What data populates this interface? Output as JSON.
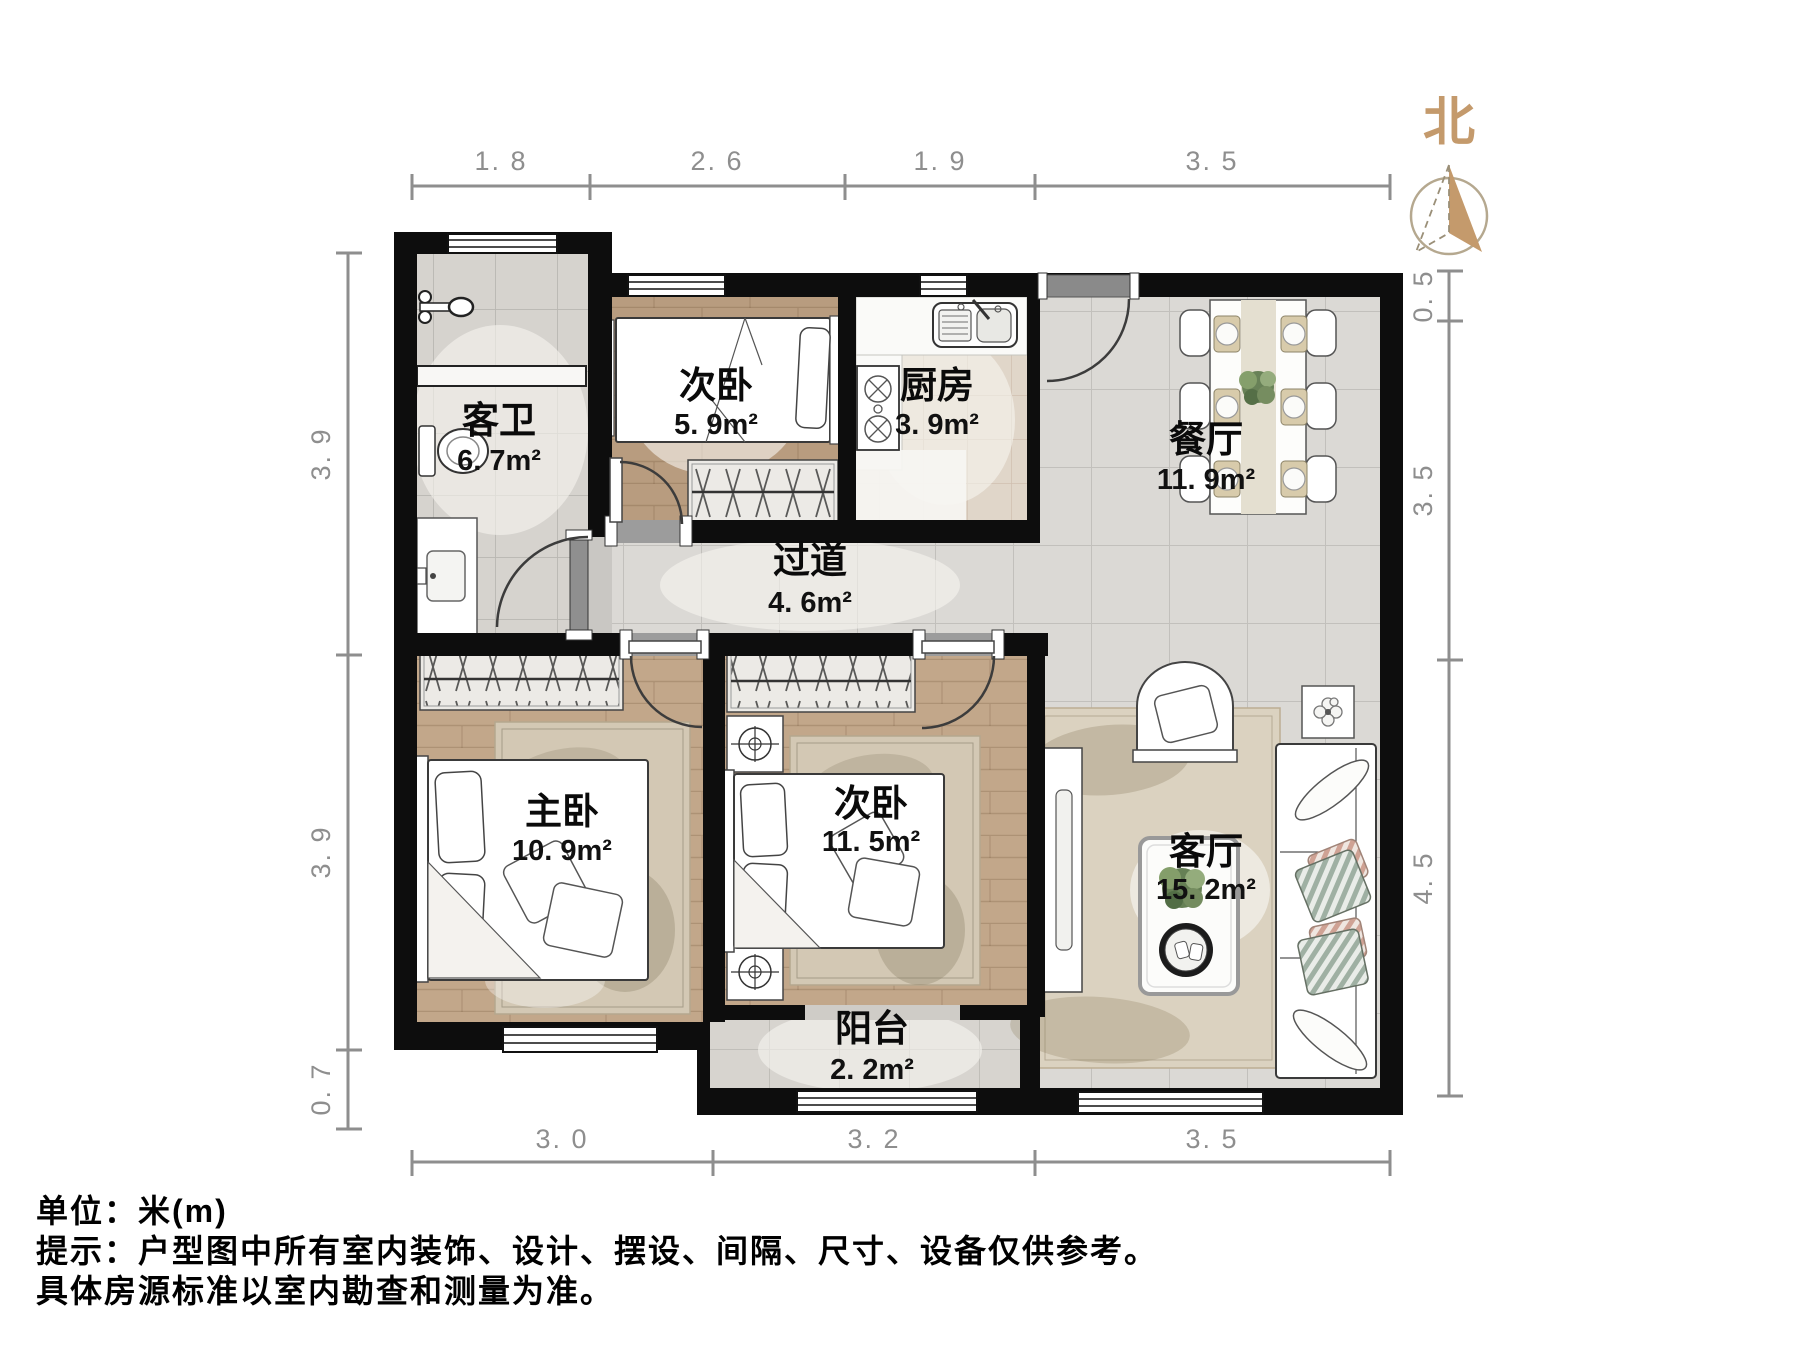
{
  "page": {
    "unit_note": "单位：米(m)",
    "tip_line1": "提示：户型图中所有室内装饰、设计、摆设、间隔、尺寸、设备仅供参考。",
    "tip_line2": "具体房源标准以室内勘查和测量为准。"
  },
  "compass": {
    "label": "北"
  },
  "rooms": {
    "bathroom": {
      "name": "客卫",
      "area": "6. 7m²"
    },
    "bedroom_top": {
      "name": "次卧",
      "area": "5. 9m²"
    },
    "kitchen": {
      "name": "厨房",
      "area": "3. 9m²"
    },
    "dining": {
      "name": "餐厅",
      "area": "11. 9m²"
    },
    "hallway": {
      "name": "过道",
      "area": "4. 6m²"
    },
    "master": {
      "name": "主卧",
      "area": "10. 9m²"
    },
    "bedroom_bottom": {
      "name": "次卧",
      "area": "11. 5m²"
    },
    "living": {
      "name": "客厅",
      "area": "15. 2m²"
    },
    "balcony": {
      "name": "阳台",
      "area": "2. 2m²"
    }
  },
  "dimensions": {
    "top": [
      "1. 8",
      "2. 6",
      "1. 9",
      "3. 5"
    ],
    "bottom": [
      "3. 0",
      "3. 2",
      "3. 5"
    ],
    "left": [
      "3. 9",
      "3. 9",
      "0. 7"
    ],
    "right": [
      "0. 5",
      "3. 5",
      "4. 5"
    ]
  },
  "colors": {
    "wall": "#0d0d0d",
    "marble_floor": "#dbd9d5",
    "wood_floor": "#c2a78a",
    "wood_floor_dark": "#b89c7f",
    "bathroom_tile": "#d6d3ce",
    "kitchen_tile": "#e0d6c9",
    "accent_north": "#c49a6c",
    "dimension_gray": "#8e8e8e",
    "door_gray": "#8f8f8f"
  }
}
